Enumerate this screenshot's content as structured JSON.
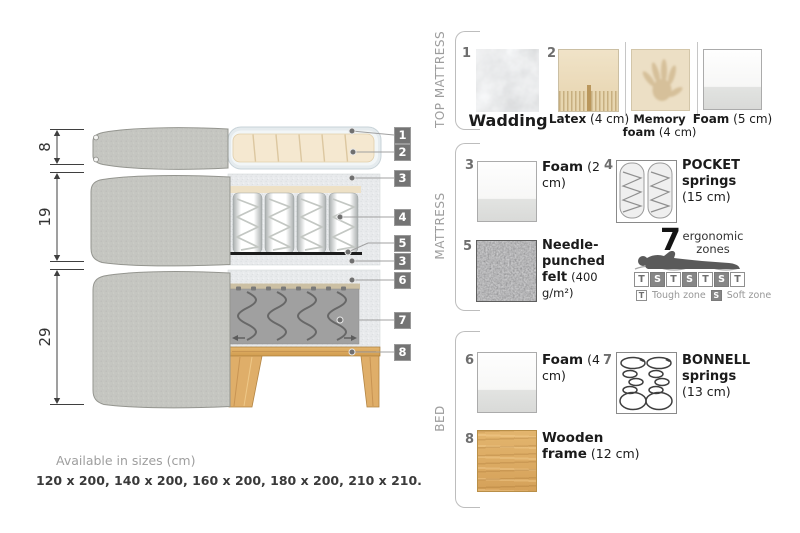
{
  "diagram": {
    "dims": [
      {
        "label": "8"
      },
      {
        "label": "19"
      },
      {
        "label": "29"
      }
    ],
    "callouts": [
      {
        "num": "1"
      },
      {
        "num": "2"
      },
      {
        "num": "3"
      },
      {
        "num": "4"
      },
      {
        "num": "5"
      },
      {
        "num": "3"
      },
      {
        "num": "6"
      },
      {
        "num": "7"
      },
      {
        "num": "8"
      }
    ]
  },
  "panel": {
    "sections": [
      {
        "label": "TOP MATTRESS",
        "items": [
          {
            "num": "1",
            "name": "Wadding",
            "size": ""
          },
          {
            "num": "2",
            "name": "Latex",
            "size": "(4 cm)"
          },
          {
            "num": "",
            "name": "Memory foam",
            "size": "(4 cm)"
          },
          {
            "num": "",
            "name": "Foam",
            "size": "(5 cm)"
          }
        ]
      },
      {
        "label": "MATTRESS",
        "items": [
          {
            "num": "3",
            "name": "Foam",
            "size": "(2 cm)"
          },
          {
            "num": "4",
            "name": "POCKET springs",
            "size": "(15 cm)"
          },
          {
            "num": "5",
            "name": "Needle-punched felt",
            "size": "(400 g/m²)"
          }
        ]
      },
      {
        "label": "BED",
        "items": [
          {
            "num": "6",
            "name": "Foam",
            "size": "(4 cm)"
          },
          {
            "num": "7",
            "name": "BONNELL springs",
            "size": "(13 cm)"
          },
          {
            "num": "8",
            "name": "Wooden frame",
            "size": "(12 cm)"
          }
        ]
      }
    ]
  },
  "ergonomic": {
    "count": "7",
    "label_line1": "ergonomic",
    "label_line2": "zones",
    "zones": [
      "T",
      "S",
      "T",
      "S",
      "T",
      "S",
      "T"
    ],
    "legend": [
      {
        "key": "T",
        "label": "Tough zone"
      },
      {
        "key": "S",
        "label": "Soft zone"
      }
    ]
  },
  "sizes": {
    "title": "Available in sizes (cm)",
    "list": "120 x 200, 140 x 200, 160 x 200, 180 x 200, 210 x 210."
  },
  "colors": {
    "fabric_grey": "#c5c6c1",
    "foam_speckle": "#e8eaec",
    "latex_cream": "#f5e8d0",
    "wood": "#ddab63",
    "felt_dark": "#6e6e6e",
    "callout_grey": "#747474",
    "muted_label": "#9d9d9d"
  }
}
